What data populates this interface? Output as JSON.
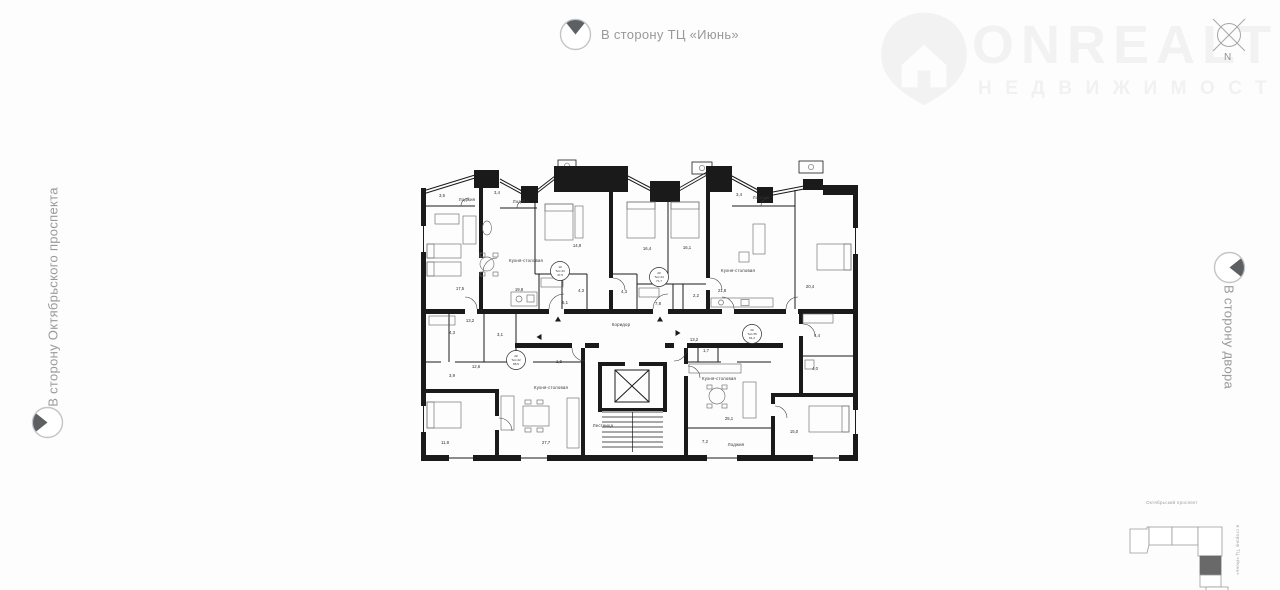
{
  "directions": {
    "top": {
      "label": "В сторону ТЦ «Июнь»"
    },
    "left": {
      "label": "В сторону Октябрьского проспекта"
    },
    "right": {
      "label": "В сторону двора"
    }
  },
  "watermark": {
    "brand": "ONREALT",
    "subtitle": "НЕДВИЖИМОСТЬ"
  },
  "compass": {
    "north_label": "N"
  },
  "minimap": {
    "street": "Октябрьский проспект",
    "side_label": "в сторону ТЦ «Июнь»"
  },
  "colors": {
    "background": "#fdfdfd",
    "walls": "#1a1a1a",
    "muted_text": "#98999b",
    "watermark": "#f2f2f2",
    "minimap_active": "#696969"
  },
  "plan": {
    "labels": [
      {
        "t": "3,5",
        "x": 21,
        "y": 31
      },
      {
        "t": "Лоджия",
        "x": 46,
        "y": 35,
        "kind": "room"
      },
      {
        "t": "3,4",
        "x": 76,
        "y": 28
      },
      {
        "t": "Лоджия",
        "x": 100,
        "y": 37,
        "kind": "room"
      },
      {
        "t": "17,5",
        "x": 39,
        "y": 124
      },
      {
        "t": "Кухня-столовая",
        "x": 105,
        "y": 96,
        "kind": "room"
      },
      {
        "t": "19,8",
        "x": 98,
        "y": 125
      },
      {
        "t": "14,9",
        "x": 156,
        "y": 81
      },
      {
        "t": "5,1",
        "x": 144,
        "y": 138
      },
      {
        "t": "4,3",
        "x": 160,
        "y": 126
      },
      {
        "t": "16,4",
        "x": 226,
        "y": 84
      },
      {
        "t": "4,3",
        "x": 203,
        "y": 127
      },
      {
        "t": "16,1",
        "x": 266,
        "y": 83
      },
      {
        "t": "7,8",
        "x": 237,
        "y": 139
      },
      {
        "t": "2,2",
        "x": 275,
        "y": 131
      },
      {
        "t": "3,4",
        "x": 318,
        "y": 30
      },
      {
        "t": "Лоджия",
        "x": 340,
        "y": 33,
        "kind": "room"
      },
      {
        "t": "21,8",
        "x": 301,
        "y": 126
      },
      {
        "t": "Кухня-столовая",
        "x": 317,
        "y": 106,
        "kind": "room"
      },
      {
        "t": "20,4",
        "x": 389,
        "y": 122
      },
      {
        "t": "13,2",
        "x": 49,
        "y": 156
      },
      {
        "t": "4,3",
        "x": 31,
        "y": 168
      },
      {
        "t": "3,1",
        "x": 79,
        "y": 170
      },
      {
        "t": "Коридор",
        "x": 200,
        "y": 160,
        "kind": "room"
      },
      {
        "t": "12,6",
        "x": 55,
        "y": 202
      },
      {
        "t": "3,9",
        "x": 31,
        "y": 211
      },
      {
        "t": "1,9",
        "x": 138,
        "y": 197
      },
      {
        "t": "Кухня-столовая",
        "x": 130,
        "y": 223,
        "kind": "room"
      },
      {
        "t": "11,8",
        "x": 24,
        "y": 278
      },
      {
        "t": "27,7",
        "x": 125,
        "y": 278
      },
      {
        "t": "Лестница",
        "x": 182,
        "y": 261,
        "kind": "room"
      },
      {
        "t": "13,2",
        "x": 273,
        "y": 175
      },
      {
        "t": "1,7",
        "x": 285,
        "y": 186
      },
      {
        "t": "Кухня-столовая",
        "x": 298,
        "y": 214,
        "kind": "room"
      },
      {
        "t": "25,1",
        "x": 308,
        "y": 254
      },
      {
        "t": "7,2",
        "x": 284,
        "y": 277
      },
      {
        "t": "Лоджия",
        "x": 315,
        "y": 280,
        "kind": "room"
      },
      {
        "t": "15,0",
        "x": 373,
        "y": 267
      },
      {
        "t": "4,4",
        "x": 396,
        "y": 171
      },
      {
        "t": "4,0",
        "x": 394,
        "y": 204
      }
    ],
    "tags": [
      {
        "lines": [
          "1К",
          "Тип 33",
          "47,5"
        ],
        "x": 139,
        "y": 105
      },
      {
        "lines": [
          "2К",
          "Тип 34",
          "71,7"
        ],
        "x": 238,
        "y": 111
      },
      {
        "lines": [
          "2К",
          "Тип 32",
          "86,5"
        ],
        "x": 95,
        "y": 194
      },
      {
        "lines": [
          "2К",
          "Тип 35",
          "81,2"
        ],
        "x": 331,
        "y": 168
      }
    ],
    "arrows": [
      {
        "x": 137,
        "y": 153,
        "dir": "up"
      },
      {
        "x": 239,
        "y": 153,
        "dir": "up"
      },
      {
        "x": 118,
        "y": 171,
        "dir": "left"
      },
      {
        "x": 257,
        "y": 167,
        "dir": "right"
      }
    ]
  }
}
